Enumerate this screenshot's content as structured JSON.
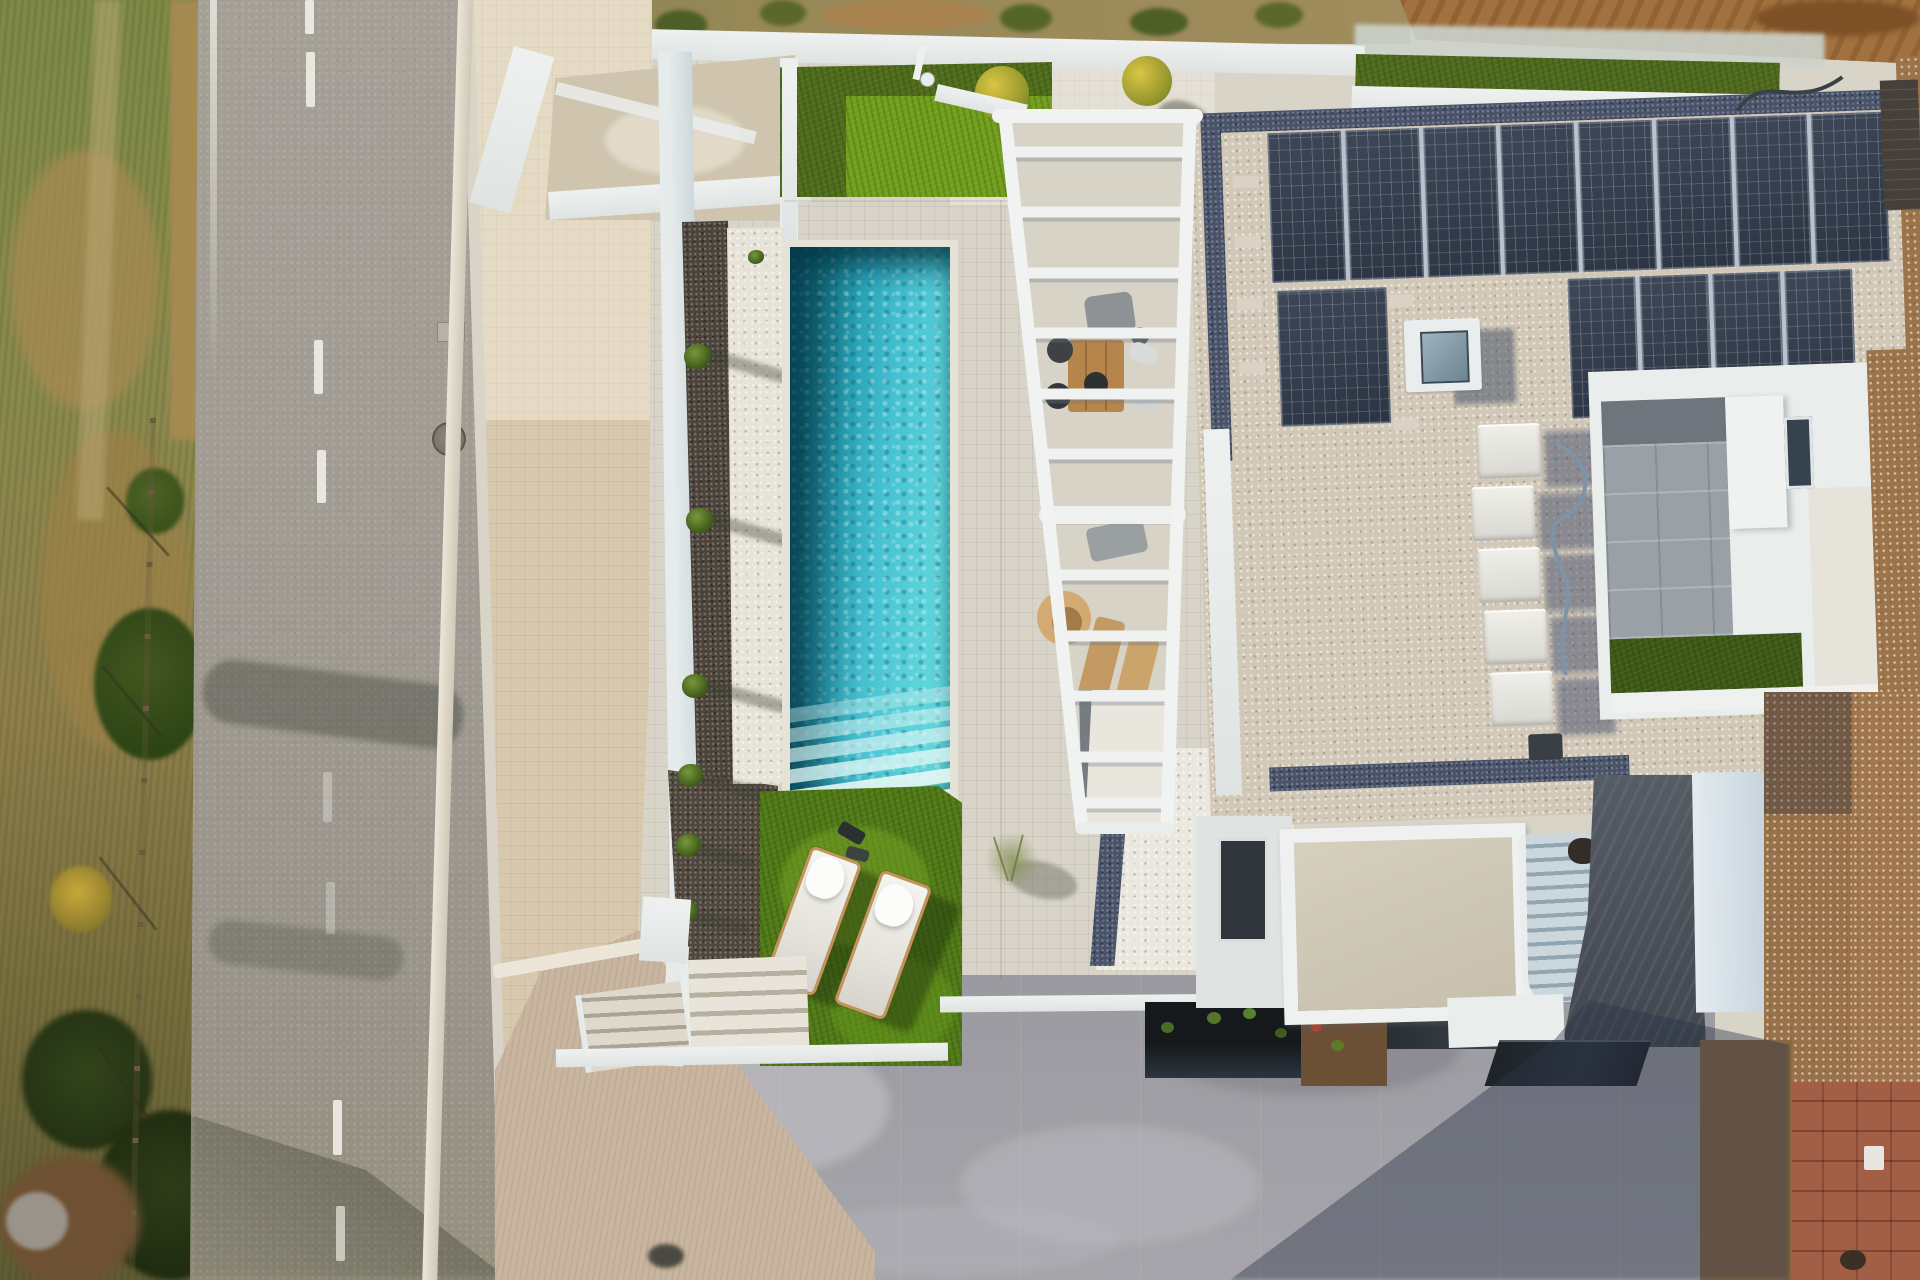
{
  "meta": {
    "type": "aerial-drone-photograph",
    "subject": "Modern white villa with rectangular pool, slatted pergola, rooftop solar array, artificial lawns, road and bare-earth plots",
    "visible_text": "none"
  },
  "palette": {
    "road": "#a19c93",
    "road-line": "#f4f2ea",
    "sidewalk": "#d8c9ae",
    "curb": "#ece6d8",
    "veg-green": "#7d8a46",
    "veg-dark": "#3f4e20",
    "veg-brown": "#a58a52",
    "dirt": "#9b7047",
    "wall-white": "#eef1ef",
    "wall-blue": "#cdd8da",
    "deck": "#d9d4c8",
    "gravel-dark": "#4c443b",
    "pebble-white": "#e7e3d9",
    "pool-deep": "#116c80",
    "pool-bright": "#5bd2da",
    "grass": "#507a16",
    "grass-bright": "#74a21d",
    "roof-gravel": "#d2c8b7",
    "pebble-border": "#49536a",
    "solar": "#2b3443",
    "ac-white": "#d8d7d1",
    "court-tile": "#99a1a7",
    "path-dark": "#4b5058",
    "stair-light": "#ccd7dd",
    "driveway": "#a2a1a7",
    "ramp": "#c9b6a0",
    "dirt-right": "#9d7349",
    "paver": "#a25f46",
    "glass": "#22262c",
    "shadow": "#2e3a50"
  },
  "scene": {
    "regions": [
      {
        "name": "scrub-verge",
        "label": "Dry scrub verge with trees, fence and yellow bush"
      },
      {
        "name": "road",
        "label": "Asphalt road with dashed white center line and manhole"
      },
      {
        "name": "sidewalk",
        "label": "Beige tiled sidewalk with curb"
      },
      {
        "name": "service-enclosure",
        "label": "Walled service enclosure at street corner"
      },
      {
        "name": "upper-lawn",
        "label": "Artificial lawn square with outdoor shower and two potted plants"
      },
      {
        "name": "planting-strips",
        "label": "Dark gravel and white pebble strips with small shrubs"
      },
      {
        "name": "pool",
        "label": "Rectangular turquoise pool with fan steps at south end"
      },
      {
        "name": "pergola",
        "label": "White slatted pergola over dining table, chairs and wooden loungers"
      },
      {
        "name": "lounger-lawn",
        "label": "Lawn with two cushioned sun loungers and towels"
      },
      {
        "name": "white-gravel-court",
        "label": "White gravel court with wispy plant"
      },
      {
        "name": "roof",
        "label": "Flat gravel roof with dark pebble border"
      },
      {
        "name": "solar-array",
        "label": "Photovoltaic array",
        "panels_row1": 8,
        "panels_row2": 6
      },
      {
        "name": "skylight",
        "label": "Square rooflight"
      },
      {
        "name": "ac-units",
        "label": "Row of rooftop AC units",
        "count": 5
      },
      {
        "name": "courtyard",
        "label": "Sunken courtyard with grey tiles, window and lawn strip"
      },
      {
        "name": "stairs",
        "label": "Curved exterior staircase to entrance"
      },
      {
        "name": "flower-beds",
        "label": "Dark planted bed and brown bed with red flowers"
      },
      {
        "name": "driveway",
        "label": "Grey concrete driveway with building shadow"
      },
      {
        "name": "pavers",
        "label": "Terracotta paver strip at bottom right"
      },
      {
        "name": "bare-earth",
        "label": "Excavated brown earth plots top and right"
      }
    ],
    "counts": {
      "sun_loungers": 2,
      "potted_plants": 2,
      "shrubs": 6,
      "ac_units": 5,
      "pool_steps": 6
    }
  }
}
